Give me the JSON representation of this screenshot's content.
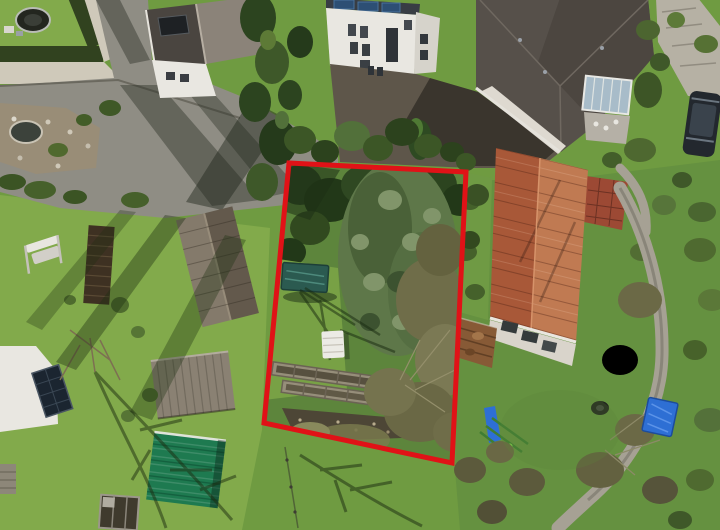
{
  "image": {
    "type": "aerial-drone-photograph",
    "width": 720,
    "height": 530,
    "description": "Aerial drone view of residential back gardens; an overgrown land plot is outlined with a red boundary polygon"
  },
  "boundary": {
    "points": "289,163 466,172 452,463 264,423",
    "stroke_width": 5
  },
  "palette": {
    "boundary_red": "#e01217",
    "lawn_base": "#6f9b41",
    "lawn_bright": "#82aa4b",
    "lawn_plot": "#5d853c",
    "meadow_right": "#659140",
    "pavement": "#8f8d84",
    "gravel": "#cfc9ba",
    "hedge_dark": "#31421f",
    "tree_dark": "#2c441f",
    "tree_mid": "#3e5829",
    "conifer": "#5e7749",
    "conifer_light": "#81956a",
    "thicket": "#6f6d49",
    "roof_dark": "#4a4540",
    "roof_light": "#8b8379",
    "roof_big": "#56504a",
    "house_white": "#e9e7e1",
    "tile_light": "#c07a52",
    "tile_dark": "#a85838",
    "shed_brown": "#7a6f5f",
    "shed_gray": "#8a8173",
    "shed_green": "#1e7a50",
    "wood_dark": "#3e3122",
    "tarp_teal": "#2b5a50",
    "tarp_blue": "#2e6fd4",
    "path_gray": "#a6a194",
    "asphalt": "#5e564a",
    "brick": "#9c4934",
    "car_dark": "#23282e",
    "soil": "#4d4636",
    "bed_wood": "#968e7a"
  },
  "objects": {
    "labels": [
      "trampoline",
      "garden-hedge",
      "paved-driveway",
      "rock-garden-pond",
      "gable-roof-house",
      "white-multistorey-house",
      "hip-roof-house",
      "conservatory",
      "red-tile-roof-building",
      "rusty-shed",
      "stone-garden-path",
      "blue-tarp",
      "tire",
      "swing-set",
      "large-conifer-tree",
      "teal-covered-pool",
      "white-bench",
      "raised-garden-beds",
      "garden-swing",
      "wood-pile-fence",
      "wooden-shed",
      "gray-shed",
      "green-roof-shed",
      "planting-table",
      "white-caravan",
      "solar-panel",
      "parked-car",
      "brick-patio",
      "garden-bench",
      "plot-boundary"
    ]
  }
}
